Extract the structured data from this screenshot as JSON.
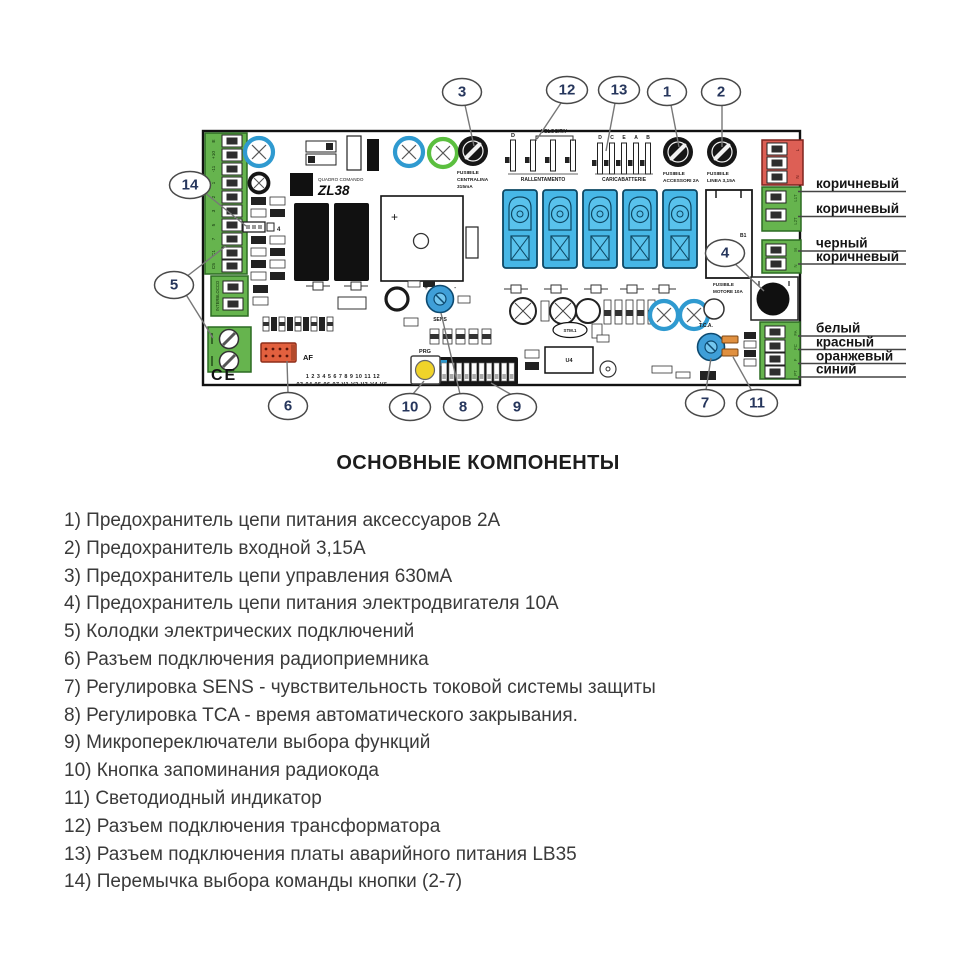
{
  "legend": {
    "title": "ОСНОВНЫЕ КОМПОНЕНТЫ",
    "items": [
      "1) Предохранитель цепи питания аксессуаров 2А",
      "2) Предохранитель входной 3,15А",
      "3) Предохранитель цепи управления 630мА",
      "4) Предохранитель цепи питания электродвигателя 10А",
      "5) Колодки электрических подключений",
      "6) Разъем подключения радиоприемника",
      "7) Регулировка SENS - чувствительность токовой системы защиты",
      "8) Регулировка TCA - время автоматического закрывания.",
      "9) Микропереключатели выбора функций",
      "10) Кнопка запоминания радиокода",
      "11) Светодиодный индикатор",
      "12) Разъем подключения трансформатора",
      "13) Разъем подключения платы аварийного питания LB35",
      "14) Перемычка выбора команды кнопки (2-7)"
    ]
  },
  "wire_labels": [
    "коричневый",
    "коричневый",
    "черный",
    "коричневый",
    "белый",
    "красный",
    "оранжевый",
    "синий"
  ],
  "callouts": [
    "1",
    "2",
    "3",
    "4",
    "5",
    "6",
    "7",
    "8",
    "9",
    "10",
    "11",
    "12",
    "13",
    "14"
  ],
  "board": {
    "model_prefix": "QUADRO COMANDO",
    "model": "ZL38",
    "fusibile": "FUSIBILE",
    "fuse_control_2": "CENTRALINA",
    "fuse_control_3": "315mA",
    "fuse_acc_2": "ACCESSORI 2A",
    "fuse_line_2": "LINEA 3,15A",
    "fuse_motor_2": "MOTORE 10A",
    "velocita": "VELOCITA'",
    "rallentamento": "RALLENTAMENTO",
    "caricabatterie": "CARICABATTERIE",
    "pin_letters": [
      "D",
      "C",
      "E",
      "A",
      "B"
    ],
    "af_label": "AF",
    "prog_label": "PRG",
    "sens_label": "SENS",
    "tca_label": "T.C.A.",
    "jumper_label": "4",
    "dip_numbers_row1": "1 2 3 4 5 6 7 8 9 10 11 12",
    "dip_numbers_row2": "03 04 05 06 07  V1 V2 V3 V4 V5",
    "ce_mark": "CE",
    "u4_label": "U4",
    "b1_label": "B1",
    "stm_label": "STM.1",
    "terminal_left_labels": [
      "E",
      "+10",
      "-11",
      "1",
      "2",
      "3",
      "5",
      "7",
      "C1",
      "C5"
    ],
    "interblocco_label": "INTERBLOCCO",
    "power_terminal_labels": [
      "L",
      "N"
    ],
    "lamp_terminal_labels": [
      "L1T",
      "L2T"
    ],
    "motor_terminal_labels": [
      "M",
      "N"
    ],
    "limit_terminal_labels": [
      "FA",
      "FC",
      "F",
      "PT"
    ]
  },
  "colors": {
    "terminal_green": "#66b44e",
    "terminal_red": "#dd5f55",
    "relay_blue": "#47b7e6",
    "trimmer_blue": "#3f9fd8",
    "cap_ring_blue": "#2f9ad0",
    "cap_ring_green": "#5bbf3f",
    "af_orange": "#e2603e",
    "led_orange": "#e09040",
    "button_yellow": "#f0d32a"
  }
}
